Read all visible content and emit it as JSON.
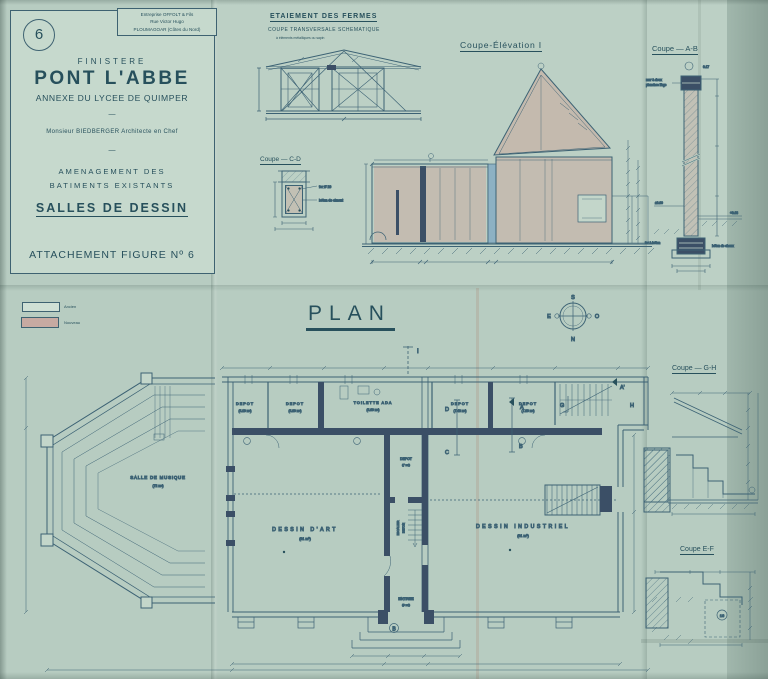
{
  "colors": {
    "paper": "#b7ccc1",
    "panel": "#c6d9cd",
    "ink": "#27505c",
    "line": "#3c6274",
    "wall_dark": "#3b4f66",
    "wash_pink": "#cf9a90",
    "wash_blue": "#7da7c2",
    "legend_old": "#cfe0d5",
    "legend_new": "#c7aaa2"
  },
  "title_block": {
    "figure_number": "6",
    "stamp": [
      "Entreprise OFFOLT & Fils",
      "Rue Victor Hugo",
      "PLOUMAGOAR (Côtes du Nord)"
    ],
    "region": "FINISTERE",
    "city": "PONT L'ABBE",
    "subtitle": "ANNEXE DU LYCEE DE QUIMPER",
    "dash": "—",
    "architect": "Monsieur BIEDBERGER   Architecte en Chef",
    "dash2": "—",
    "project_line1": "AMENAGEMENT DES",
    "project_line2": "BATIMENTS EXISTANTS",
    "sheet_title": "SALLES DE DESSIN",
    "caption": "ATTACHEMENT FIGURE Nº 6"
  },
  "sections": {
    "etaiement": {
      "title": "ETAIEMENT DES FERMES",
      "subtitle": "COUPE TRANSVERSALE SCHEMATIQUE",
      "note": "à éléments métalliques ou sapin"
    },
    "coupe_cd": {
      "title": "Coupe — C-D",
      "label_fer": "fer Ø 20",
      "label_beton": "béton de ciment"
    },
    "coupe_elevation": {
      "title": "Coupe-Élévation I"
    },
    "coupe_ab": {
      "title": "Coupe — A-B",
      "label_mur1": "mur à deux",
      "label_mur2": "planches liège",
      "mark_top": "0.17",
      "level_left": "±0.00",
      "level_right": "+0.68",
      "label_fond1": "fer à béton",
      "label_fond2": "béton de chaux"
    },
    "coupe_gh": {
      "title": "Coupe — G-H"
    },
    "coupe_ef": {
      "title": "Coupe E-F",
      "step_count": "16"
    }
  },
  "plan": {
    "title": "PLAN",
    "legend": [
      {
        "label": "Ancien",
        "color": "#cfe0d5"
      },
      {
        "label": "Nouveau",
        "color": "#c7aaa2"
      }
    ],
    "compass": {
      "n": "N",
      "s": "S",
      "e": "E",
      "o": "O"
    },
    "rooms": {
      "depot1": {
        "name": "DEPOT",
        "area": "(4.10 m²)"
      },
      "depot2": {
        "name": "DEPOT",
        "area": "(4.80 m²)"
      },
      "toilette": {
        "name": "TOILETTE ADA",
        "area": "(4.60 m²)"
      },
      "depot3": {
        "name": "DEPOT",
        "area": "(7.48 m²)"
      },
      "depot4": {
        "name": "DEPOT",
        "area": "(7.80 m²)"
      },
      "depot5": {
        "name": "DEPOT",
        "area": "(7 m²)"
      },
      "musique": {
        "name": "SALLE DE MUSIQUE",
        "area": "(72 m²)"
      },
      "art": {
        "name": "DESSIN D'ART",
        "area": "(61 m²)"
      },
      "industriel": {
        "name": "DESSIN INDUSTRIEL",
        "area": "(61 m²)"
      },
      "entree": {
        "name": "ENTREE",
        "area": "(9 m²)"
      }
    },
    "stair_label1": "ESCALIER",
    "stair_label2": "BETON",
    "markers": {
      "i": "I",
      "a": "A",
      "b": "B",
      "c": "C",
      "d": "D",
      "g": "G",
      "h": "H",
      "a_prime": "A'",
      "b_entry": "B"
    }
  }
}
